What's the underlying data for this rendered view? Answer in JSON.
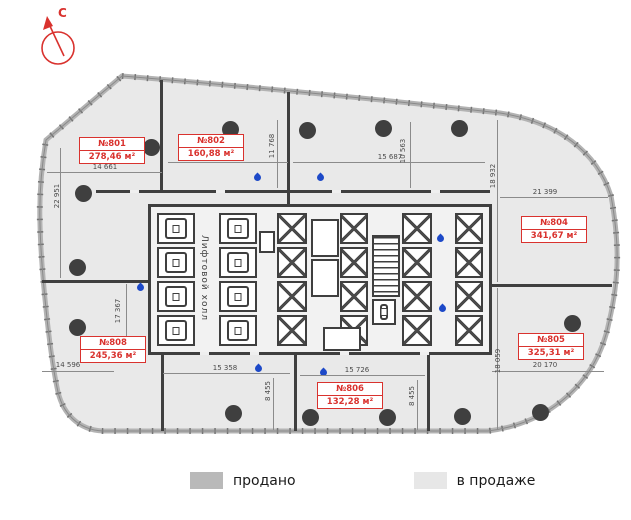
{
  "compass": {
    "north_label": "С"
  },
  "units": [
    {
      "number": "№801",
      "area": "278,46 м²"
    },
    {
      "number": "№802",
      "area": "160,88 м²"
    },
    {
      "number": "№804",
      "area": "341,67 м²"
    },
    {
      "number": "№805",
      "area": "325,31 м²"
    },
    {
      "number": "№806",
      "area": "132,28 м²"
    },
    {
      "number": "№808",
      "area": "245,36 м²"
    }
  ],
  "core": {
    "hall_label": "Лифтовой холл"
  },
  "dimensions": [
    "14 661",
    "13 990",
    "11 768",
    "15 687",
    "10 563",
    "18 932",
    "21 399",
    "22 951",
    "17 367",
    "14 596",
    "15 358",
    "8 455",
    "15 726",
    "8 455",
    "20 170",
    "18 059"
  ],
  "legend": [
    {
      "label": "продано",
      "color": "#b9b9b9"
    },
    {
      "label": "в продаже",
      "color": "#e7e7e7"
    }
  ],
  "colors": {
    "unit_label": "#d9322e",
    "walls": "#3f3f3f",
    "floor_for_sale": "#e9e9e9",
    "water_drop": "#1d49c8"
  }
}
